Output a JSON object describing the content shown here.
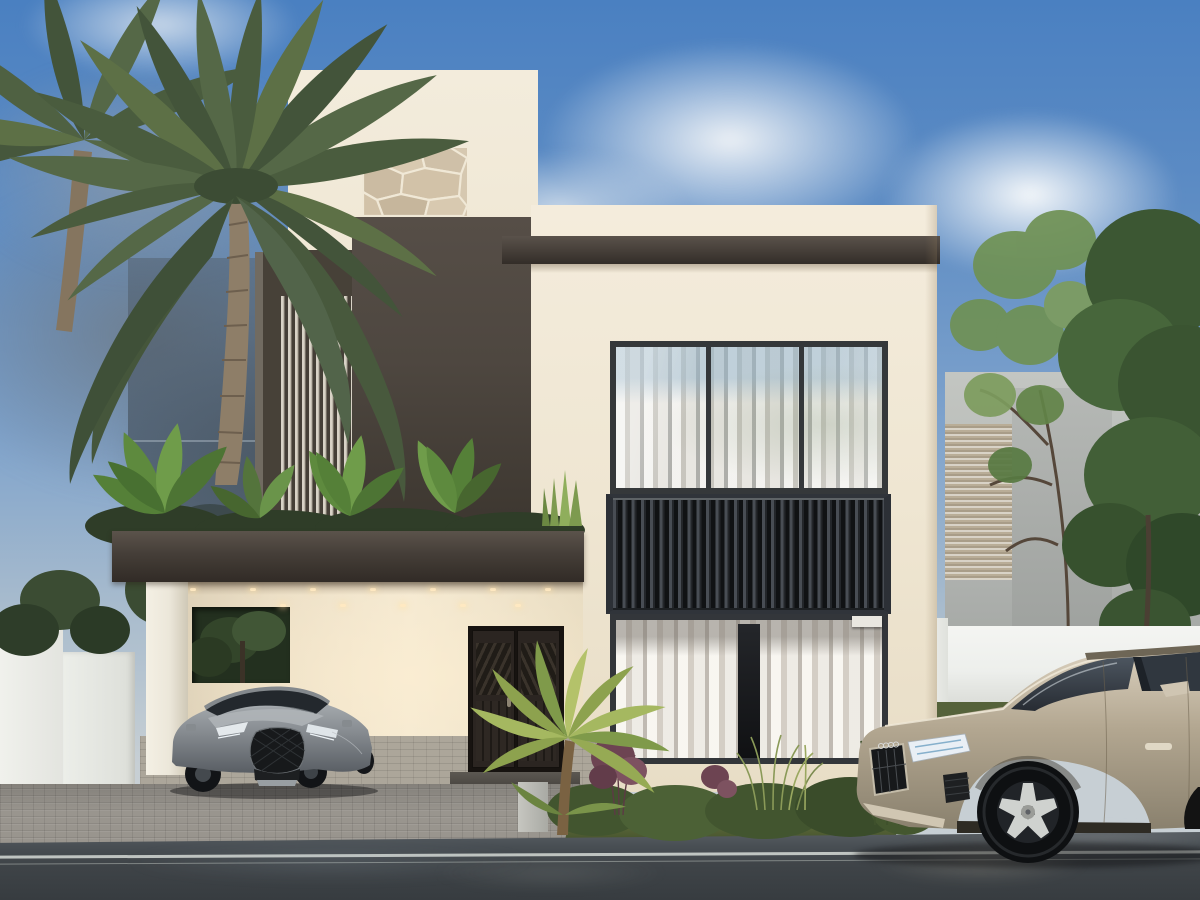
{
  "meta": {
    "description": "Photorealistic exterior rendering of a modern two-storey villa at dusk/daytime with a carport, two SUVs and tropical landscaping. No text is visible anywhere in the image.",
    "image_kind": "architectural-3d-render"
  },
  "palette": {
    "sky_top": "#4a80c1",
    "sky_mid": "#7fa3cc",
    "sky_horizon": "#c7cfd4",
    "cloud_grey": "#7e8b97",
    "cloud_white": "#f3f5f7",
    "wall_cream": "#efe6d2",
    "wall_cream_dark": "#ddd2ba",
    "wall_warm": "#f4e9d2",
    "dark_grey": "#4e4740",
    "dark_grey_deep": "#38322d",
    "stone_beige": "#d6c8b0",
    "louver_light": "#d8d2c6",
    "glass_blue": "#8fa9ba",
    "curtain_white": "#eceae3",
    "slat_dark": "#1d2023",
    "door_brown": "#2b2521",
    "canopy_dark": "#453e38",
    "column_white": "#ece7da",
    "paver_grey": "#99958e",
    "paver_warm": "#aca69a",
    "road_dark": "#373c40",
    "road_light": "#565c61",
    "grass_green": "#5c6a3a",
    "foliage_dark": "#34452c",
    "foliage_mid": "#4c6438",
    "foliage_light": "#6f9c4a",
    "palm_green": "#4f6142",
    "trunk_brown": "#8b7b65",
    "fence_white": "#edefec",
    "neighbor_grey": "#b2b5b2",
    "lexus_silver": "#868b90",
    "audi_champagne": "#b8ac96",
    "white_line": "#dfe3df",
    "downlight_warm": "#ffe9c2"
  },
  "scene": {
    "sky": "blue sky, white cumulus clouds right of the tower, grey-blue cloud mass behind the palm on the left",
    "objects": [
      {
        "name": "palm-tree",
        "note": "tall date palm left foreground, second palm trunk at far left edge"
      },
      {
        "name": "villa",
        "note": "white stucco two-storey house; stucco tower with stone inlay panel; dark grey feature wall; vertical louver screen; long dark roof beam"
      },
      {
        "name": "upper-window",
        "note": "three-pane window with white curtains and sky reflection"
      },
      {
        "name": "balcony-slat-band",
        "note": "dark vertical wood slats between upper and lower windows"
      },
      {
        "name": "lower-window",
        "note": "curtained window with dark centre gap"
      },
      {
        "name": "carport",
        "note": "dark flat canopy with recessed warm downlights, white column, wall opening showing a tree, roof terrace garden with glass railing above"
      },
      {
        "name": "front-door",
        "note": "dark brown double door with chevron louvers, step and grey pedestal in front"
      },
      {
        "name": "lexus-suv",
        "note": "silver-grey compact SUV parked under carport on pavers"
      },
      {
        "name": "audi-suv",
        "note": "champagne/silver large SUV on the wet road at right, cropped by image edge"
      },
      {
        "name": "landscaping",
        "note": "terrace tropical plants, hedge and red-purple shrubs at house base, small golden palm by the door, grass verge"
      },
      {
        "name": "neighbour-building",
        "note": "grey building with louvered facade behind trees at right"
      },
      {
        "name": "white-fence",
        "note": "bright white compound walls on both sides"
      },
      {
        "name": "street",
        "note": "wet dark asphalt with double white edge line and reflections; grey interlock paver driveway"
      }
    ]
  }
}
